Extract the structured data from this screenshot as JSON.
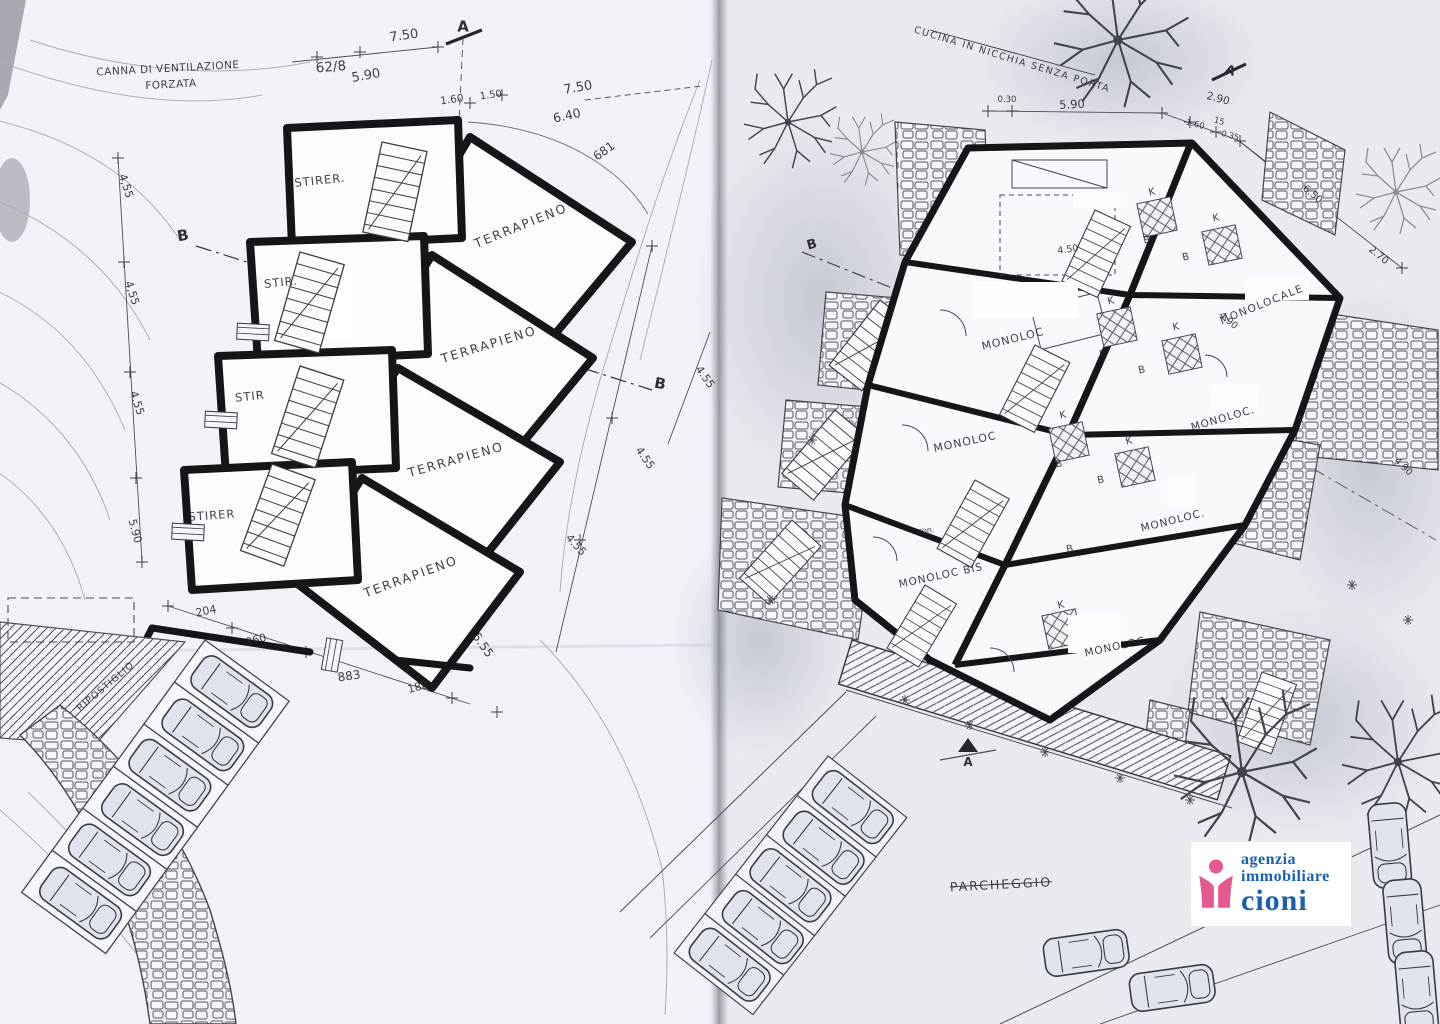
{
  "scan": {
    "left_page_tint": "#f3f5fa",
    "right_page_tint": "#eceef3",
    "ink_color": "#17181c"
  },
  "logo": {
    "agency_line1": "agenzia",
    "agency_line2": "immobiliare",
    "agency_name": "cioni",
    "text_color": "#1961ac",
    "icon_color": "#e45a90",
    "icon": "person-icon"
  },
  "left_plan": {
    "labels": [
      {
        "text": "CANNA DI VENTILAZIONE"
      },
      {
        "text": "FORZATA"
      },
      {
        "text": "7.50"
      },
      {
        "text": "5.90"
      },
      {
        "text": "62/8"
      },
      {
        "text": "A"
      },
      {
        "text": "1.60"
      },
      {
        "text": "1.50"
      },
      {
        "text": "7.50"
      },
      {
        "text": "6.40"
      },
      {
        "text": "681"
      },
      {
        "text": "STIRER."
      },
      {
        "text": "TERRAPIENO"
      },
      {
        "text": "B"
      },
      {
        "text": "STIR."
      },
      {
        "text": "TERRAPIENO"
      },
      {
        "text": "STIR"
      },
      {
        "text": "TERRAPIENO"
      },
      {
        "text": "STIRER"
      },
      {
        "text": "TERRAPIENO"
      },
      {
        "text": "B"
      },
      {
        "text": "4,55"
      },
      {
        "text": "4,55"
      },
      {
        "text": "4.55"
      },
      {
        "text": "5.90"
      },
      {
        "text": "4.55"
      },
      {
        "text": "4.55"
      },
      {
        "text": "4.55"
      },
      {
        "text": "5.55"
      },
      {
        "text": "204"
      },
      {
        "text": "360"
      },
      {
        "text": "883"
      },
      {
        "text": "188"
      },
      {
        "text": "RIPOSTIGLIO"
      }
    ]
  },
  "right_plan": {
    "labels": [
      {
        "text": "CUCINA IN NICCHIA SENZA PORTA"
      },
      {
        "text": "0.30"
      },
      {
        "text": "5.90"
      },
      {
        "text": "A"
      },
      {
        "text": "2.90"
      },
      {
        "text": "1.60"
      },
      {
        "text": "15"
      },
      {
        "text": "0.35"
      },
      {
        "text": "6.50"
      },
      {
        "text": "2.70"
      },
      {
        "text": "4.50"
      },
      {
        "text": "MONOLOCALE"
      },
      {
        "text": "4.90"
      },
      {
        "text": "MONOLOC"
      },
      {
        "text": "MONOLOC"
      },
      {
        "text": "MONOLOC."
      },
      {
        "text": "MONOLOC."
      },
      {
        "text": "MONOLOC BIS"
      },
      {
        "text": "MONOLOC."
      },
      {
        "text": "4.90"
      },
      {
        "text": "B"
      },
      {
        "text": "A"
      },
      {
        "text": "PARCHEGGIO"
      },
      {
        "text": "con."
      }
    ],
    "letters": [
      {
        "text": "K"
      },
      {
        "text": "K"
      },
      {
        "text": "K"
      },
      {
        "text": "K"
      },
      {
        "text": "K"
      },
      {
        "text": "K"
      },
      {
        "text": "K"
      },
      {
        "text": "B"
      },
      {
        "text": "B"
      },
      {
        "text": "B"
      },
      {
        "text": "B"
      },
      {
        "text": "B"
      },
      {
        "text": "B"
      },
      {
        "text": "B"
      }
    ]
  }
}
